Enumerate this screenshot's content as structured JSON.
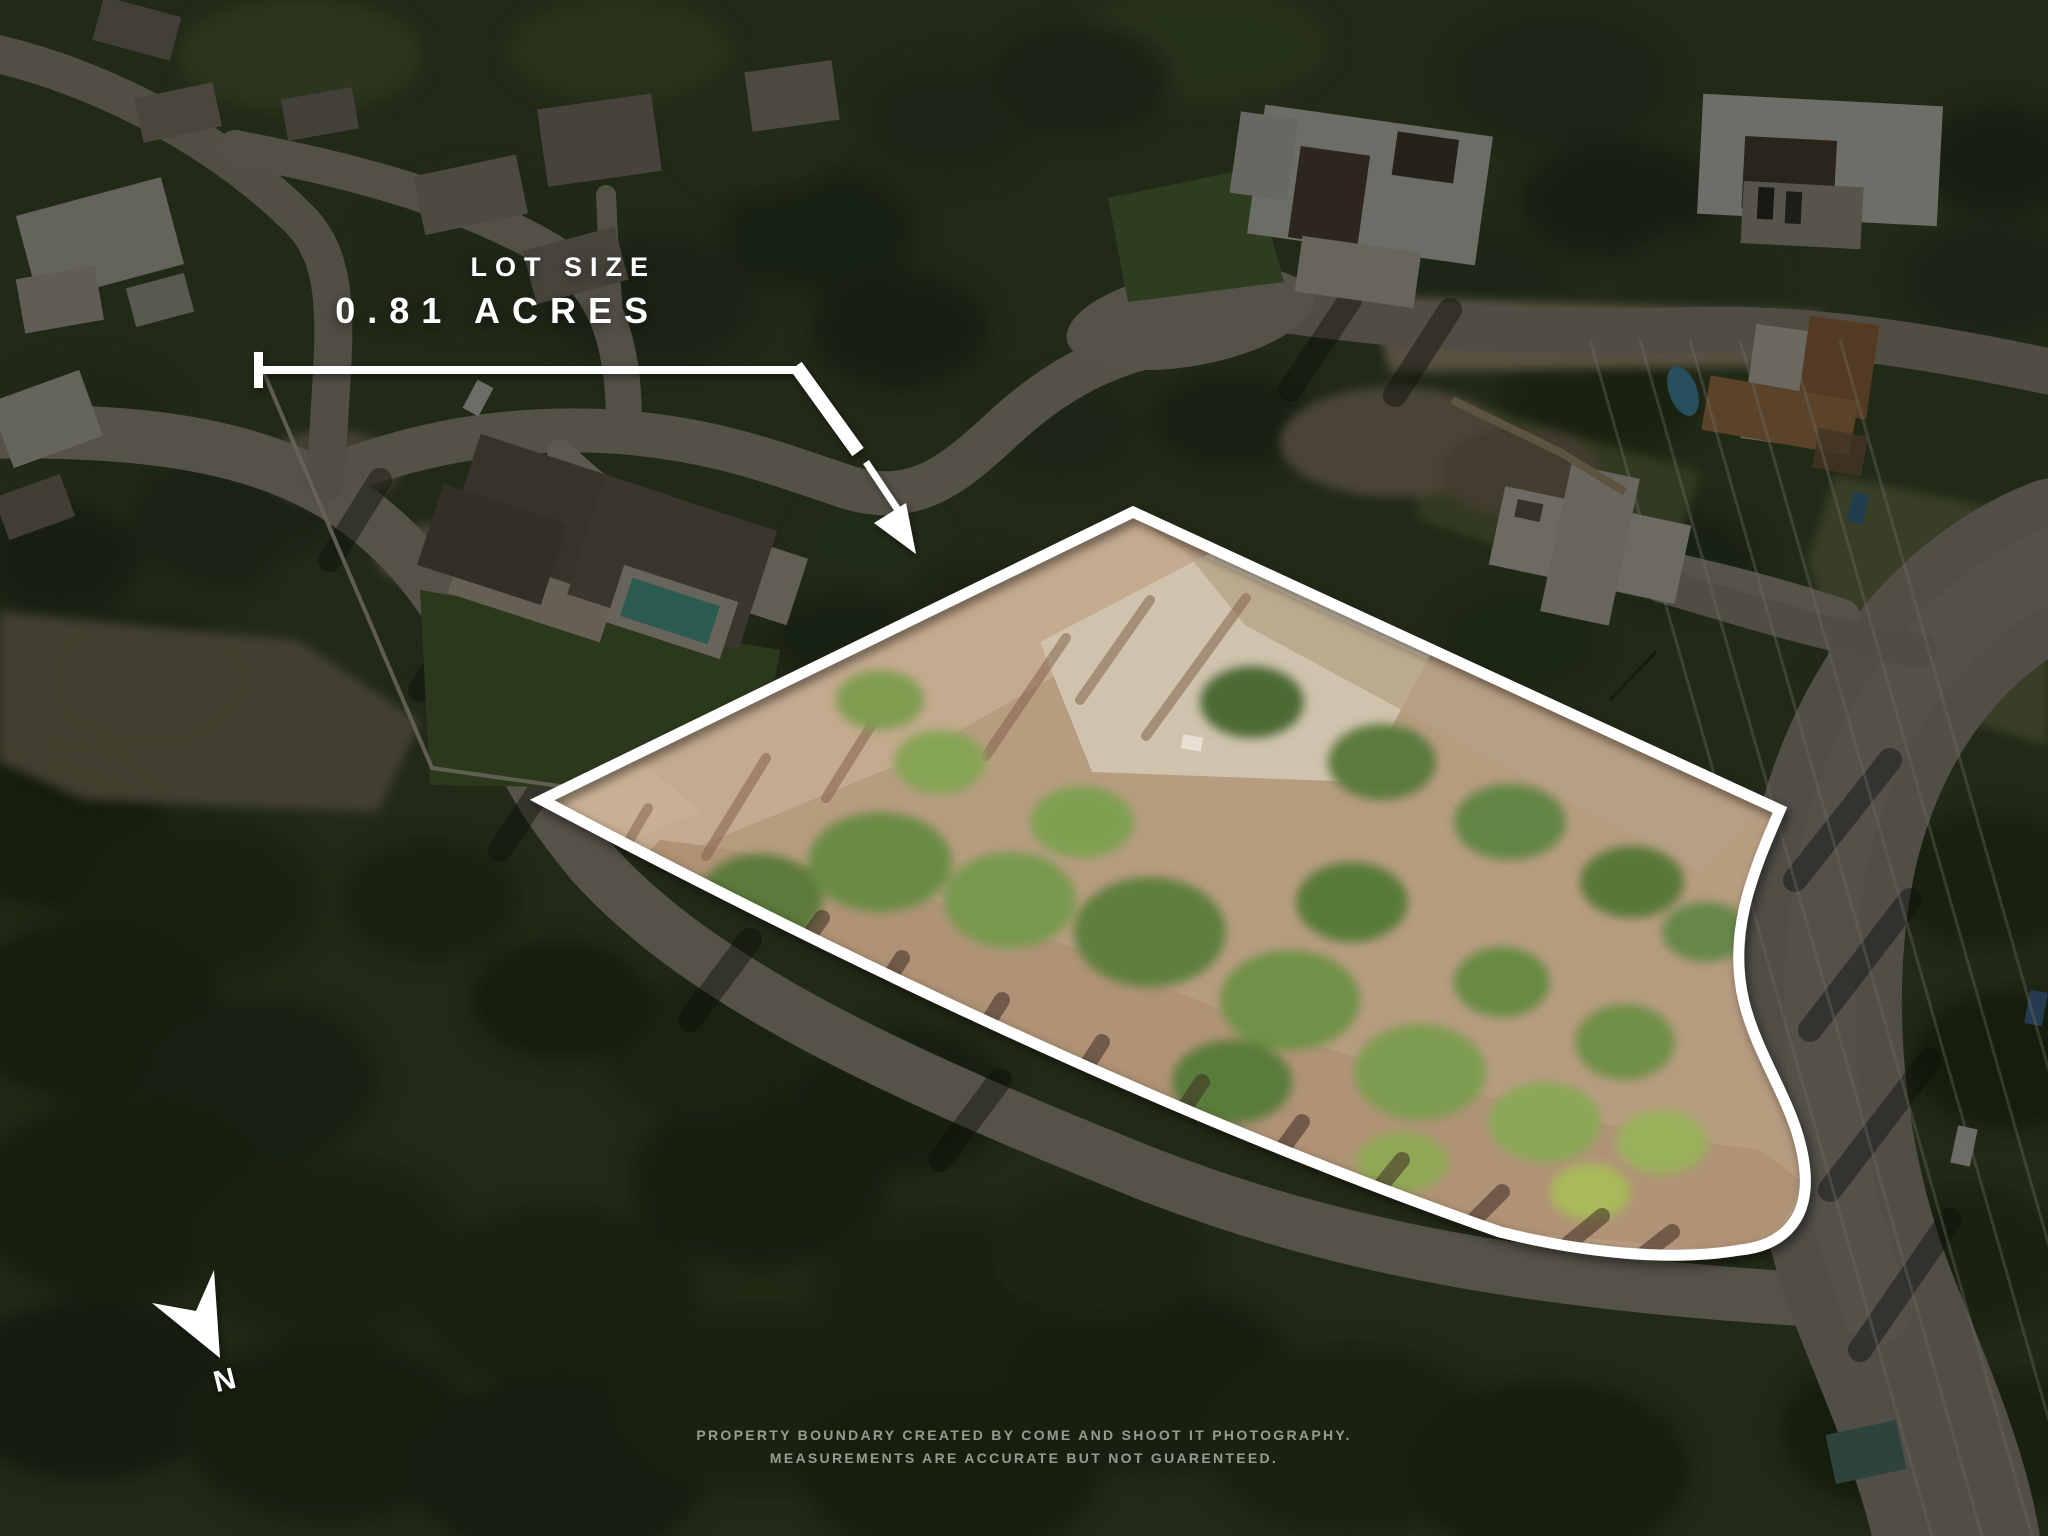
{
  "overlay_text": {
    "lot_size_label": "LOT SIZE",
    "lot_size_value": "0.81 ACRES",
    "compass_letter": "N",
    "disclaimer_line1": "PROPERTY BOUNDARY CREATED BY COME AND SHOOT IT PHOTOGRAPHY.",
    "disclaimer_line2": "MEASUREMENTS ARE ACCURATE BUT NOT GUARENTEED."
  },
  "colors": {
    "boundary_line": "#ffffff",
    "annotation_text": "#ffffff",
    "disclaimer_text": "rgba(255,255,255,0.55)",
    "photo_dim_overlay": "rgba(7,9,5,0.55)"
  }
}
